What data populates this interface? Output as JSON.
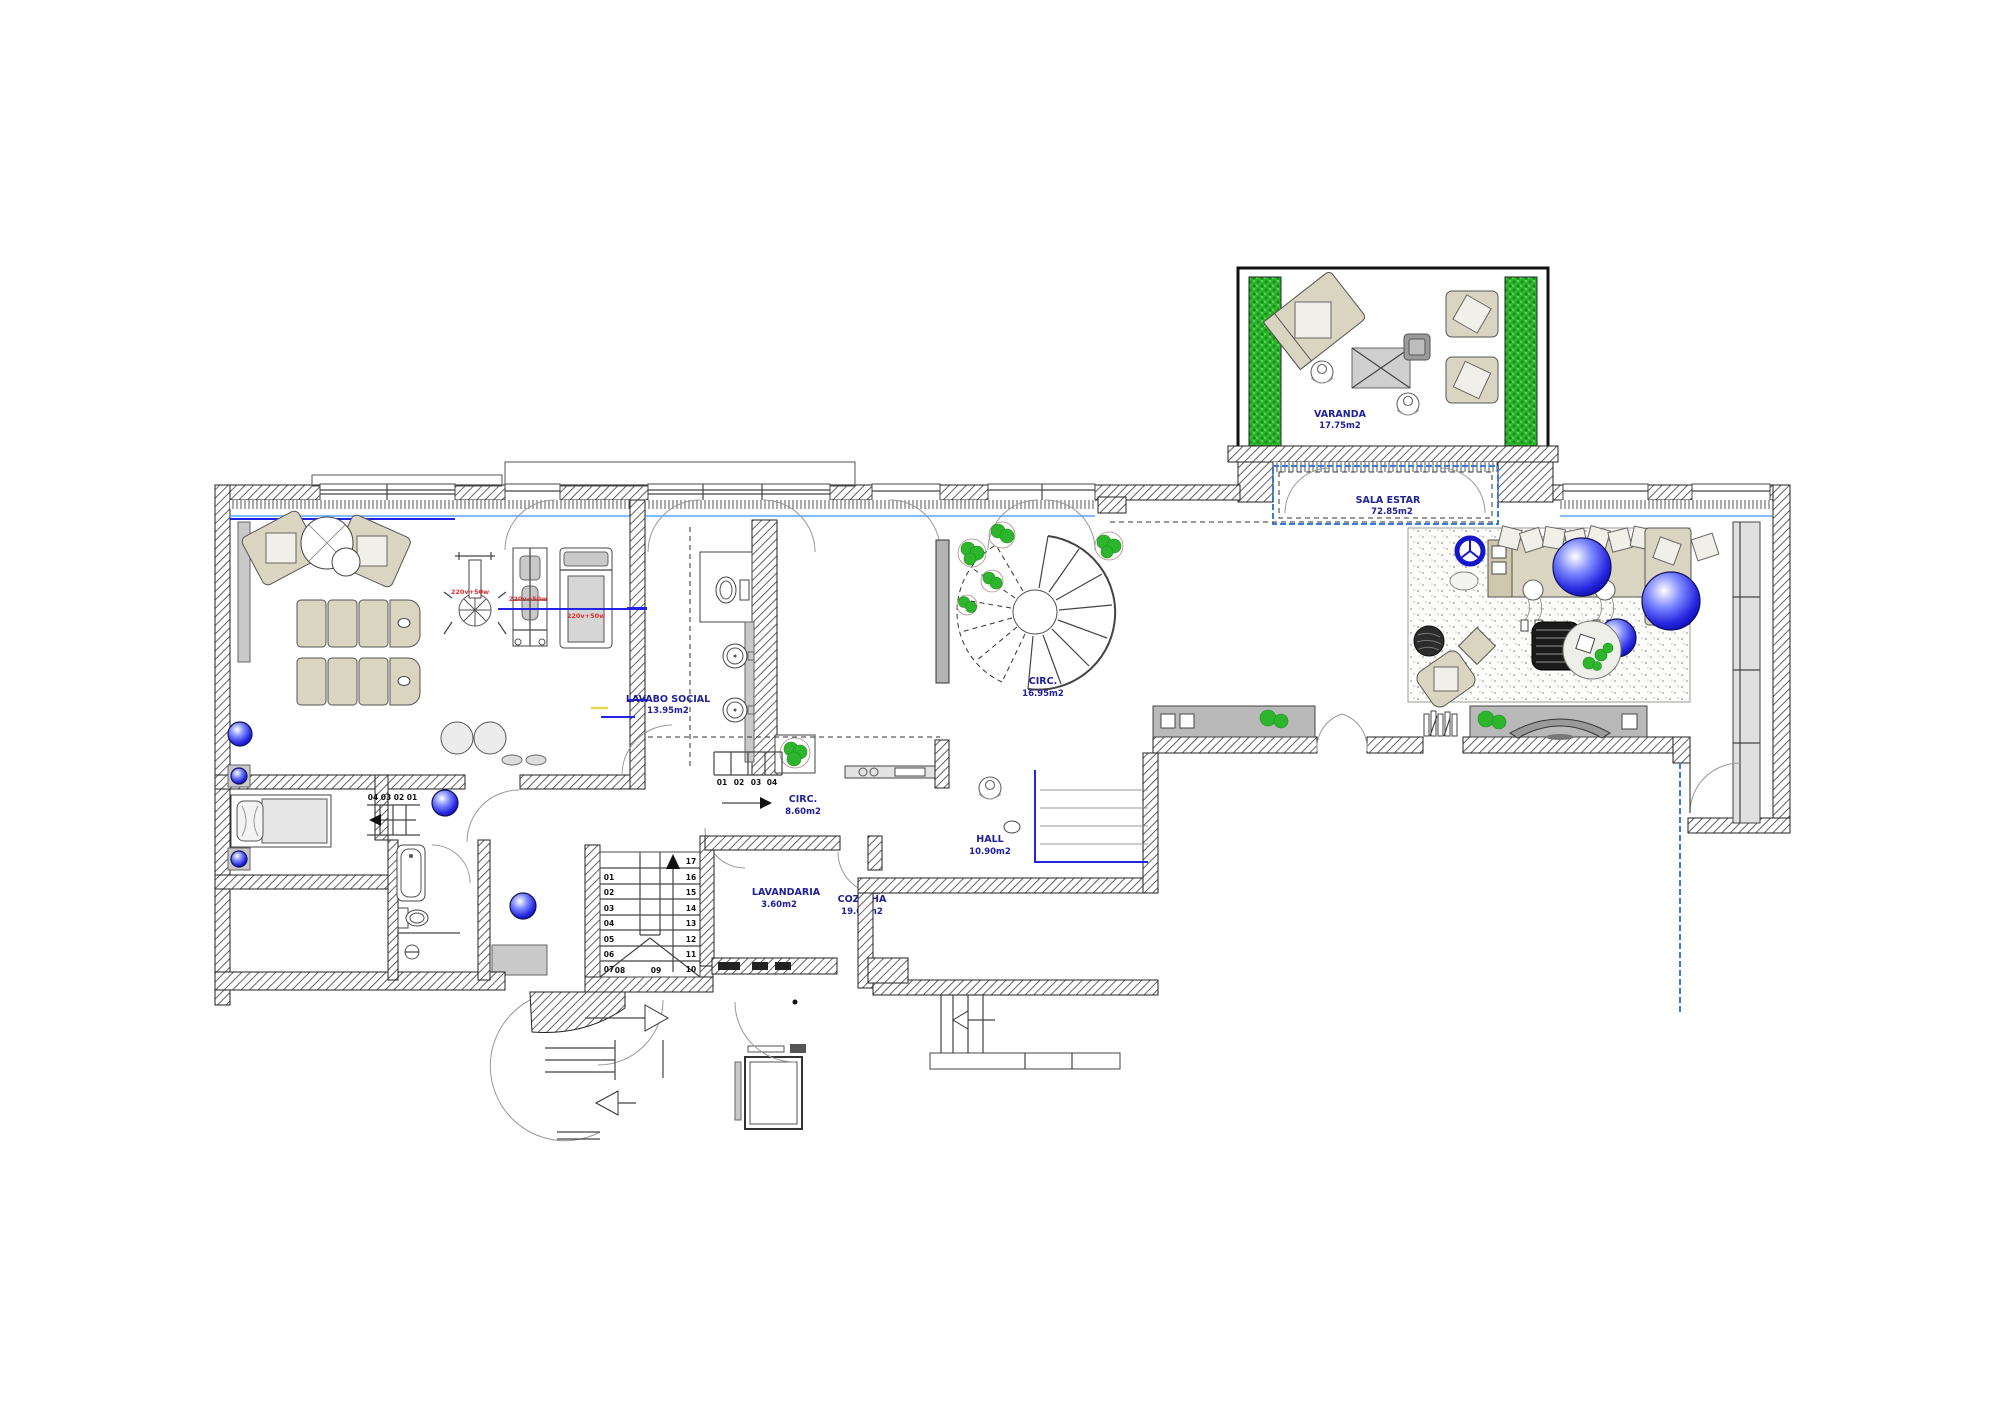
{
  "labels": {
    "varanda": {
      "name": "VARANDA",
      "area": "17.75m2"
    },
    "sala_estar": {
      "name": "SALA ESTAR",
      "area": "72.85m2"
    },
    "lavabo_social": {
      "name": "LAVABO SOCIAL",
      "area": "13.95m2"
    },
    "circ_spiral": {
      "name": "CIRC.",
      "area": "16.95m2"
    },
    "circ_corridor": {
      "name": "CIRC.",
      "area": "8.60m2"
    },
    "hall": {
      "name": "HALL",
      "area": "10.90m2"
    },
    "lavandaria": {
      "name": "LAVANDARIA",
      "area": "3.60m2"
    },
    "cozinha": {
      "name": "COZINHA",
      "area": "19.00m2"
    }
  },
  "equipment": {
    "bike": "220v+50w",
    "station": "220v+50w",
    "treadmill": "220v+50w"
  },
  "stair_main": {
    "left": [
      "01",
      "02",
      "03",
      "04",
      "05",
      "06",
      "07"
    ],
    "bottom": [
      "08",
      "09"
    ],
    "right_top": "17",
    "right": [
      "16",
      "15",
      "14",
      "13",
      "12",
      "11",
      "10"
    ]
  },
  "stair_bed": [
    "04",
    "03",
    "02",
    "01"
  ],
  "stair_corridor": [
    "01",
    "02",
    "03",
    "04"
  ],
  "colors": {
    "label_blue": "#20209a",
    "red_label": "#e03030",
    "plant_green": "#2db52d",
    "sphere_blue": "#1515d0",
    "line_blue": "#2323e6",
    "glass_blue": "#58a6ff",
    "wall": "#2f2f2f"
  }
}
